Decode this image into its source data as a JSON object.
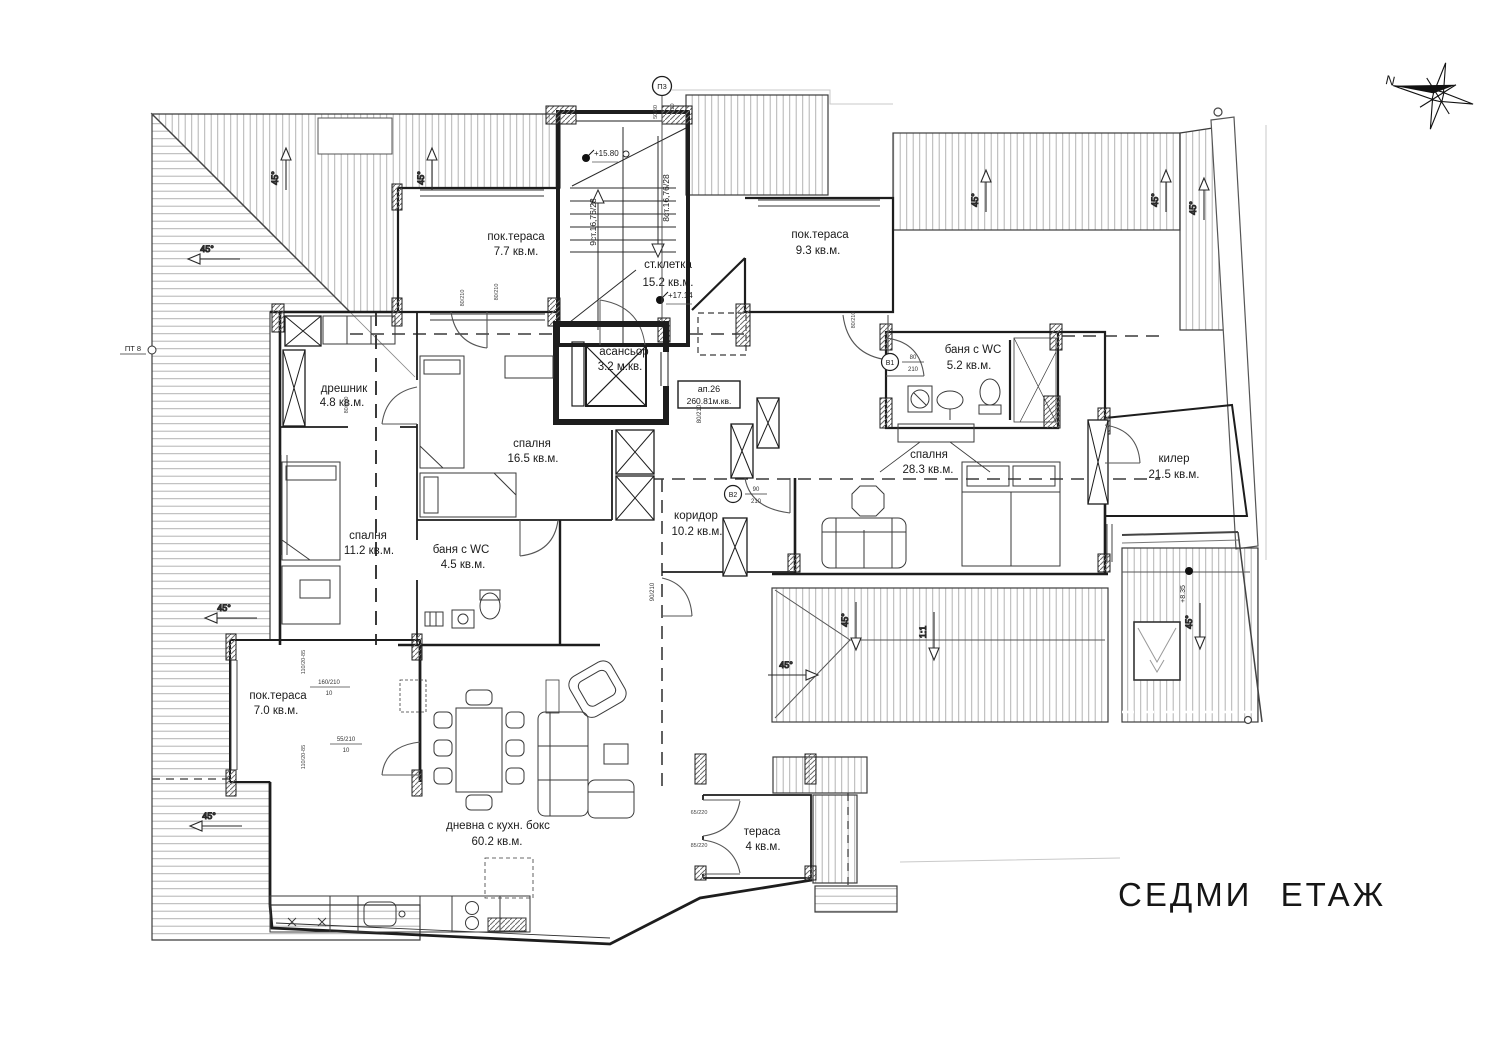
{
  "title": "СЕДМИ ЕТАЖ",
  "apartment": {
    "label": "ап.26",
    "area": "260.81м.кв."
  },
  "rooms": [
    {
      "name": "пок.тераса",
      "area": "7.7 кв.м."
    },
    {
      "name": "ст.клетка",
      "area": "15.2 кв.м."
    },
    {
      "name": "пок.тераса",
      "area": "9.3 кв.м."
    },
    {
      "name": "асансьор",
      "area": "3.2 м.кв."
    },
    {
      "name": "дрешник",
      "area": "4.8 кв.м."
    },
    {
      "name": "спалня",
      "area": "16.5 кв.м."
    },
    {
      "name": "баня с WC",
      "area": "5.2 кв.м."
    },
    {
      "name": "спалня",
      "area": "28.3 кв.м."
    },
    {
      "name": "килер",
      "area": "21.5 кв.м."
    },
    {
      "name": "спалня",
      "area": "11.2 кв.м."
    },
    {
      "name": "баня с WC",
      "area": "4.5 кв.м."
    },
    {
      "name": "коридор",
      "area": "10.2 кв.м."
    },
    {
      "name": "пок.тераса",
      "area": "7.0 кв.м."
    },
    {
      "name": "дневна с кухн. бокс",
      "area": "60.2 кв.м."
    },
    {
      "name": "тераса",
      "area": "4 кв.м."
    }
  ],
  "stairs": {
    "run_left": "9ст.16,76/28",
    "run_right": "8ст.16,76/28"
  },
  "elevations": {
    "e1": "+15.80",
    "e2": "+17.14",
    "e3": "+8.35"
  },
  "markers": {
    "p3": "П3",
    "p3_d1": "50/80",
    "p3_d2": "120",
    "pt8": "ПТ 8",
    "b1": "В1",
    "b1_num": "80",
    "b1_den": "210",
    "b2": "В2",
    "b2_num": "90",
    "b2_den": "210"
  },
  "dims": {
    "d1": "160/210",
    "d1_sub": "10",
    "d2": "55/210",
    "d2_sub": "10",
    "d3": "90/210",
    "d4": "80/210",
    "d5": "65/220",
    "d6": "85/220",
    "d7": "110/20-85",
    "d8": "80/210"
  },
  "slopes": {
    "deg": "45°",
    "ratio": "1:1"
  },
  "compass": {
    "north": "N"
  },
  "colors": {
    "line": "#1d1d1d",
    "hatch": "#b0b0b0",
    "dash": "#3a3a3a"
  }
}
